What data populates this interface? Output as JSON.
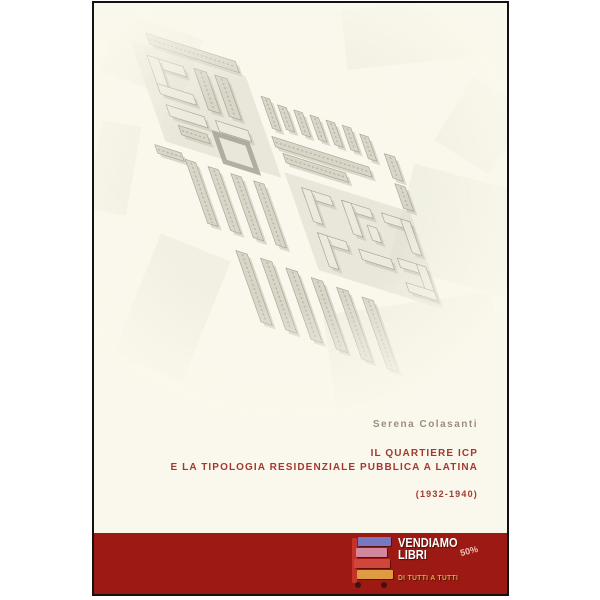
{
  "page": {
    "bg": "#ffffff"
  },
  "cover": {
    "bg": "#faf8ec",
    "border_color": "#141210",
    "author": "Serena Colasanti",
    "author_color": "#9b8c80",
    "title_line1": "IL QUARTIERE ICP",
    "title_line2": "E LA TIPOLOGIA RESIDENZIALE PUBBLICA A LATINA",
    "years": "(1932-1940)",
    "title_color": "#a23931"
  },
  "publisher_band": {
    "bg": "#9c1a13",
    "name_line1": "VENDIAMO",
    "name_line2": "LIBRI",
    "tagline": "DI TUTTI A TUTTI",
    "tagline_color": "#e9a23b",
    "badge": "50%",
    "badge_color": "#efc0b8",
    "book_cart": {
      "post_color": "#c6312a",
      "wheel_color": "#401210",
      "book_colors": [
        "#7679bf",
        "#d2879d",
        "#cf463a",
        "#de9b41"
      ]
    }
  },
  "site_plan": {
    "description": "Faded gray axonometric site plan of the ICP housing quarter with rows of slab blocks and courtyard buildings",
    "axis": [
      0.95,
      0.3,
      0.33,
      0.94,
      50,
      58
    ],
    "parcel_color": "#dcdacd",
    "building_fill": "#e8e6da",
    "building_fill_dark": "#cfcdbf",
    "stroke": "#8f8d7f",
    "shadow": "#b5b3a4",
    "context_color": "#dcdacc",
    "parcels": [
      [
        -8,
        -20,
        122,
        108
      ],
      [
        120,
        80,
        132,
        104
      ]
    ],
    "buildings": [
      [
        14,
        -34,
        94,
        12,
        1
      ],
      [
        6,
        -8,
        38,
        11,
        0
      ],
      [
        6,
        -8,
        12,
        40,
        0
      ],
      [
        6,
        22,
        38,
        11,
        0
      ],
      [
        56,
        -10,
        13,
        44,
        1
      ],
      [
        78,
        -10,
        13,
        44,
        1
      ],
      [
        8,
        44,
        40,
        12,
        0
      ],
      [
        60,
        44,
        34,
        12,
        0
      ],
      [
        14,
        64,
        30,
        10,
        1
      ],
      [
        54,
        60,
        34,
        30,
        2
      ],
      [
        124,
        -2,
        9,
        34,
        1
      ],
      [
        140,
        2,
        9,
        26,
        1
      ],
      [
        157,
        2,
        9,
        26,
        1
      ],
      [
        174,
        2,
        9,
        26,
        1
      ],
      [
        191,
        2,
        9,
        26,
        1
      ],
      [
        208,
        2,
        9,
        26,
        1
      ],
      [
        225,
        6,
        9,
        26,
        1
      ],
      [
        120,
        42,
        102,
        11,
        1
      ],
      [
        126,
        58,
        66,
        10,
        1
      ],
      [
        246,
        20,
        11,
        26,
        1
      ],
      [
        246,
        52,
        11,
        26,
        1
      ],
      [
        134,
        92,
        30,
        10,
        0
      ],
      [
        134,
        92,
        10,
        36,
        0
      ],
      [
        176,
        92,
        30,
        10,
        0
      ],
      [
        176,
        92,
        10,
        36,
        0
      ],
      [
        196,
        112,
        10,
        16,
        0
      ],
      [
        218,
        92,
        30,
        10,
        0
      ],
      [
        238,
        92,
        10,
        36,
        0
      ],
      [
        134,
        140,
        30,
        10,
        0
      ],
      [
        134,
        140,
        10,
        36,
        0
      ],
      [
        176,
        144,
        34,
        11,
        0
      ],
      [
        218,
        140,
        30,
        10,
        0
      ],
      [
        238,
        140,
        10,
        36,
        0
      ],
      [
        218,
        166,
        30,
        10,
        0
      ],
      [
        -22,
        96,
        28,
        9,
        1
      ],
      [
        8,
        102,
        11,
        68,
        1
      ],
      [
        32,
        102,
        11,
        68,
        1
      ],
      [
        56,
        102,
        11,
        68,
        1
      ],
      [
        80,
        102,
        11,
        68,
        1
      ],
      [
        30,
        192,
        12,
        76,
        1
      ],
      [
        56,
        192,
        12,
        76,
        1
      ],
      [
        82,
        194,
        12,
        76,
        1
      ],
      [
        108,
        196,
        12,
        76,
        1
      ],
      [
        134,
        198,
        12,
        76,
        1
      ],
      [
        160,
        200,
        12,
        76,
        1
      ]
    ],
    "context": [
      [
        15,
        20,
        85,
        65,
        20
      ],
      [
        250,
        0,
        135,
        60,
        -6
      ],
      [
        305,
        175,
        125,
        105,
        15
      ],
      [
        40,
        240,
        75,
        130,
        22
      ],
      [
        235,
        300,
        170,
        95,
        -8
      ],
      [
        355,
        85,
        65,
        75,
        32
      ],
      [
        0,
        120,
        40,
        90,
        10
      ]
    ]
  }
}
